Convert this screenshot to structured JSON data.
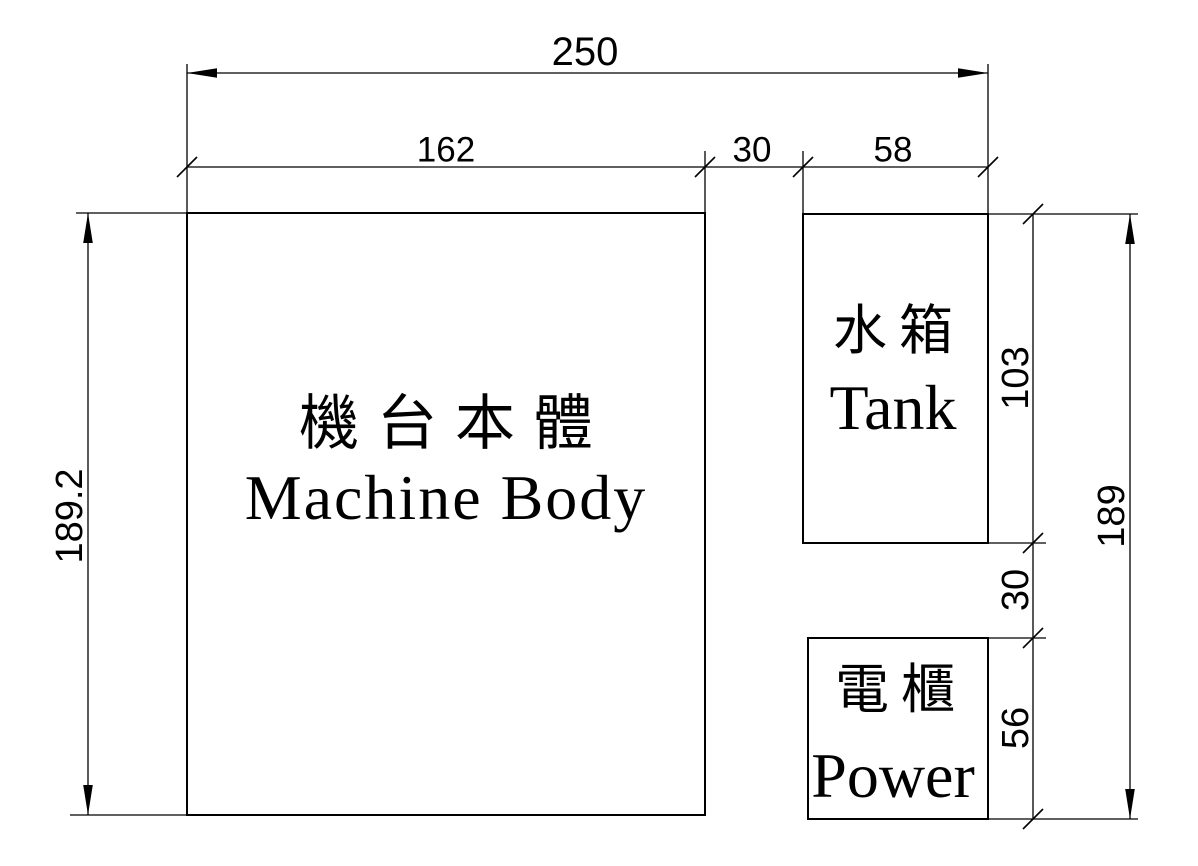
{
  "colors": {
    "background": "#ffffff",
    "line": "#000000",
    "text": "#000000"
  },
  "boxes": {
    "machine": {
      "name_cjk": "機台本體",
      "name_en": "Machine Body"
    },
    "tank": {
      "name_cjk": "水箱",
      "name_en": "Tank"
    },
    "power": {
      "name_cjk": "電櫃",
      "name_en": "Power"
    }
  },
  "dims": {
    "overall_width": "250",
    "machine_width": "162",
    "gap_horizontal": "30",
    "tank_width": "58",
    "machine_height": "189.2",
    "tank_height": "103",
    "gap_vertical": "30",
    "power_height": "56",
    "overall_height": "189"
  }
}
